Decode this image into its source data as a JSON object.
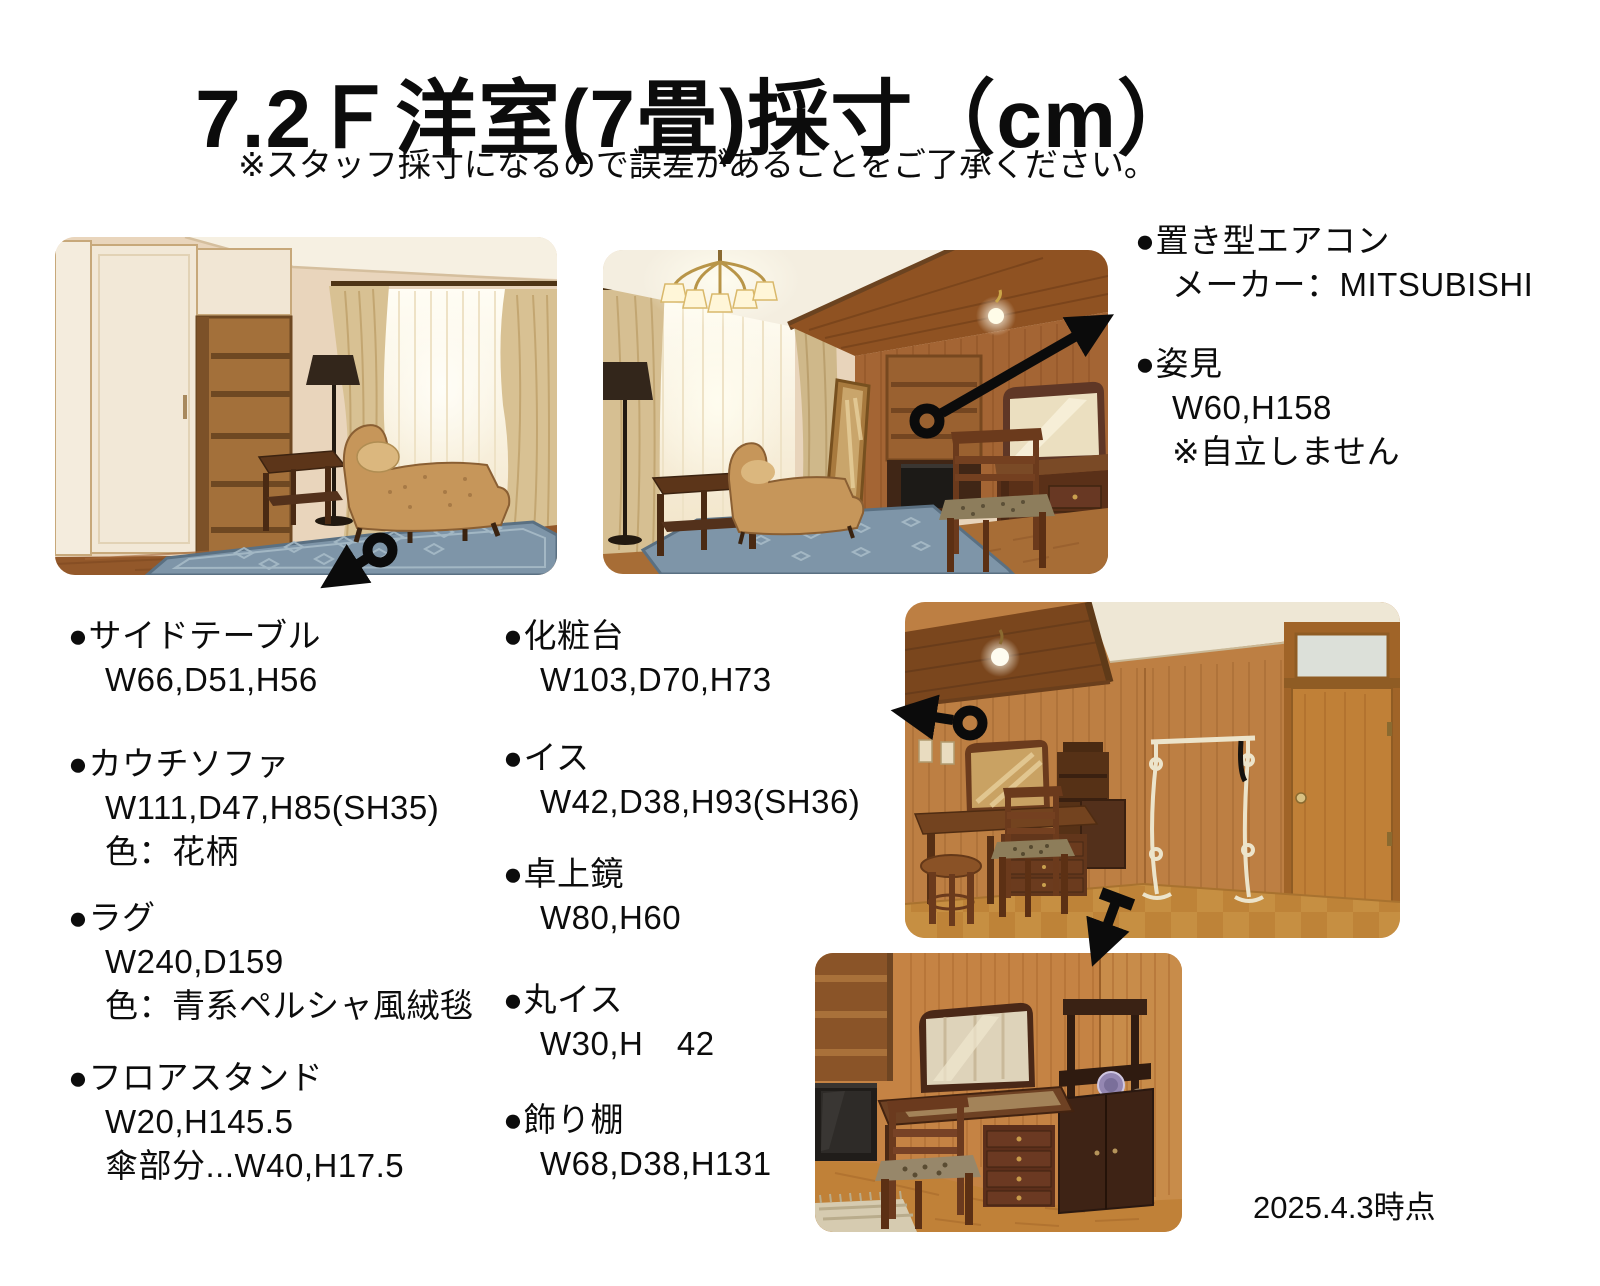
{
  "page": {
    "title": "7.2Ｆ洋室(7畳)採寸（cm）",
    "subtitle": "※スタッフ採寸になるので誤差があることをご了承ください。",
    "date_note": "2025.4.3時点",
    "bullet": "●"
  },
  "annotations": {
    "left": [
      {
        "name": "サイドテーブル",
        "lines": [
          "W66,D51,H56"
        ]
      },
      {
        "name": "カウチソファ",
        "lines": [
          "W111,D47,H85(SH35)",
          "色：花柄"
        ]
      },
      {
        "name": "ラグ",
        "lines": [
          "W240,D159",
          "色：青系ペルシャ風絨毯"
        ]
      },
      {
        "name": "フロアスタンド",
        "lines": [
          "W20,H145.5",
          "傘部分...W40,H17.5"
        ]
      }
    ],
    "middle": [
      {
        "name": "化粧台",
        "lines": [
          "W103,D70,H73"
        ]
      },
      {
        "name": "イス",
        "lines": [
          "W42,D38,H93(SH36)"
        ]
      },
      {
        "name": "卓上鏡",
        "lines": [
          "W80,H60"
        ]
      },
      {
        "name": "丸イス",
        "lines": [
          "W30,H　42"
        ]
      },
      {
        "name": "飾り棚",
        "lines": [
          "W68,D38,H131"
        ]
      }
    ],
    "right": [
      {
        "name": "置き型エアコン",
        "lines": [
          "メーカー：MITSUBISHI"
        ]
      },
      {
        "name": "姿見",
        "lines": [
          "W60,H158",
          "※自立しません"
        ]
      }
    ]
  },
  "colors": {
    "ink": "#0b0b0b",
    "rug_blue": "#7e95a8",
    "wood_wall": "#a46534",
    "curtain": "#d8c193"
  }
}
